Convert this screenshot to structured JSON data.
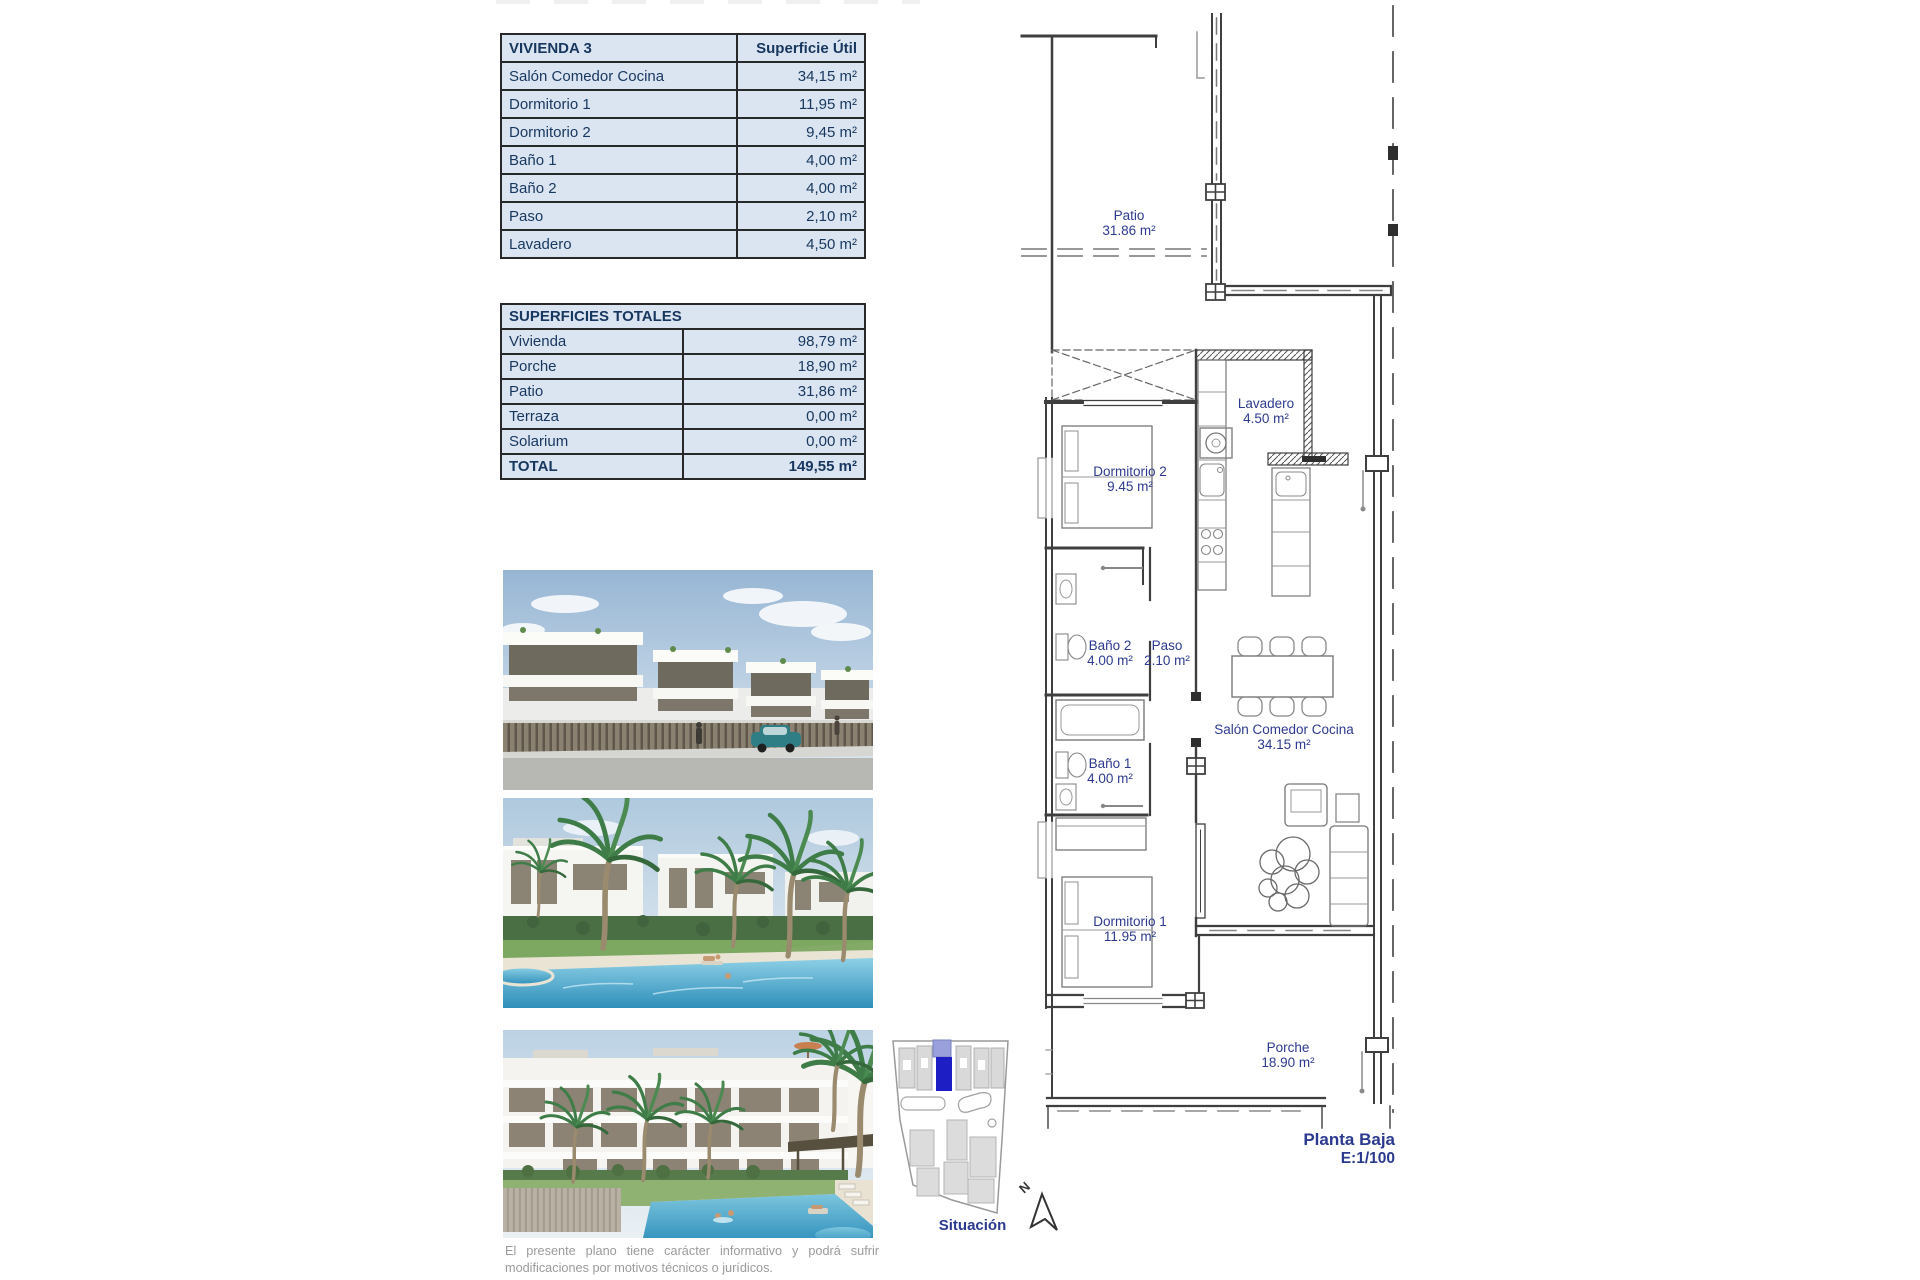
{
  "tables": {
    "vivienda": {
      "title": "VIVIENDA 3",
      "col_header": "Superficie Útil",
      "rows": [
        {
          "label": "Salón Comedor Cocina",
          "value": "34,15 m²"
        },
        {
          "label": "Dormitorio 1",
          "value": "11,95 m²"
        },
        {
          "label": "Dormitorio 2",
          "value": "9,45 m²"
        },
        {
          "label": "Baño 1",
          "value": "4,00 m²"
        },
        {
          "label": "Baño 2",
          "value": "4,00 m²"
        },
        {
          "label": "Paso",
          "value": "2,10 m²"
        },
        {
          "label": "Lavadero",
          "value": "4,50 m²"
        }
      ]
    },
    "totales": {
      "title": "SUPERFICIES TOTALES",
      "rows": [
        {
          "label": "Vivienda",
          "value": "98,79 m²"
        },
        {
          "label": "Porche",
          "value": "18,90 m²"
        },
        {
          "label": "Patio",
          "value": "31,86 m²"
        },
        {
          "label": "Terraza",
          "value": "0,00 m²"
        },
        {
          "label": "Solarium",
          "value": "0,00 m²"
        }
      ],
      "total": {
        "label": "TOTAL",
        "value": "149,55 m²"
      }
    }
  },
  "floor_plan": {
    "rooms": [
      {
        "name": "Patio",
        "area": "31.86 m²"
      },
      {
        "name": "Lavadero",
        "area": "4.50 m²"
      },
      {
        "name": "Dormitorio 2",
        "area": "9.45 m²"
      },
      {
        "name": "Baño 2",
        "area": "4.00 m²"
      },
      {
        "name": "Paso",
        "area": "2.10 m²"
      },
      {
        "name": "Salón Comedor Cocina",
        "area": "34.15 m²"
      },
      {
        "name": "Baño 1",
        "area": "4.00 m²"
      },
      {
        "name": "Dormitorio 1",
        "area": "11.95 m²"
      },
      {
        "name": "Porche",
        "area": "18.90 m²"
      }
    ],
    "caption_line1": "Planta Baja",
    "caption_line2": "E:1/100",
    "north_label": "N"
  },
  "situacion": {
    "label": "Situación",
    "highlight_color": "#1d1fc4"
  },
  "footer": {
    "line1": "El presente plano tiene carácter informativo y podrá sufrir",
    "line2": "modificaciones por motivos técnicos o jurídicos."
  },
  "colors": {
    "table_fill": "#dbe5f1",
    "table_text": "#17375e",
    "plan_label": "#2d3a8f",
    "caption_text": "#2b3a8e",
    "footer_text": "#9b9b9b"
  }
}
